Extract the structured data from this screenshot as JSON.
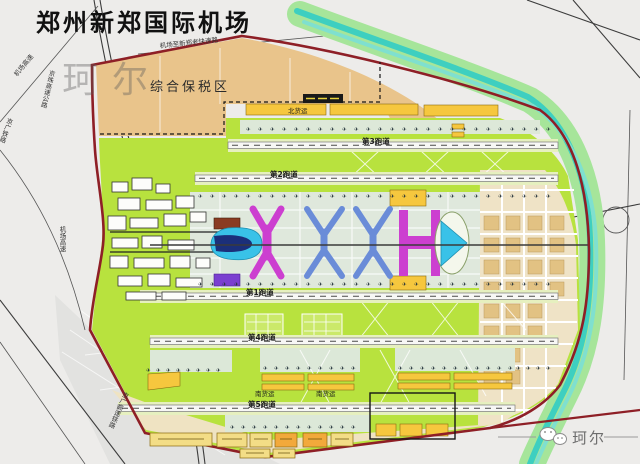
{
  "title": "郑州新郑国际机场",
  "watermark": {
    "topleft": "珂尔",
    "bottomright": "珂尔"
  },
  "zones": {
    "bonded": "综合保税区",
    "north_cargo": "北货运",
    "south_cargo_1": "南货运",
    "south_cargo_2": "南货运"
  },
  "runways": [
    {
      "label": "第3跑道"
    },
    {
      "label": "第2跑道"
    },
    {
      "label": "第1跑道"
    },
    {
      "label": "第4跑道"
    },
    {
      "label": "第5跑道"
    }
  ],
  "roads": {
    "top_expressway": "机场至新郑老快速路",
    "airport_expwy_nw": "机场高速",
    "airport_expwy_w": "机场高速",
    "jingzhu_expwy": "京珠高速公路",
    "railway": "京广铁路",
    "hsr": "京广高速铁路"
  },
  "colors": {
    "boundary_red": "#8e1f26",
    "airfield_green": "#b8e23e",
    "bonded_tan": "#e9c48b",
    "cargo_yellow": "#f6c73e",
    "river_green": "#a6e59a",
    "river_teal": "#3ecfc0",
    "terminal_magenta": "#cc3fd0",
    "terminal_blue": "#6a8cd8",
    "terminal_cyan": "#39c2e8",
    "city_block_tan": "#e2c283"
  },
  "decor": {
    "aircraft_glyph": "✈",
    "aircraft_rows": [
      {
        "x": 246,
        "y": 131,
        "n": 26,
        "g": 12
      },
      {
        "x": 198,
        "y": 198,
        "n": 30,
        "g": 12
      },
      {
        "x": 198,
        "y": 286,
        "n": 30,
        "g": 12
      },
      {
        "x": 146,
        "y": 372,
        "n": 8,
        "g": 10
      },
      {
        "x": 263,
        "y": 370,
        "n": 9,
        "g": 11
      },
      {
        "x": 398,
        "y": 370,
        "n": 11,
        "g": 11
      },
      {
        "x": 230,
        "y": 429,
        "n": 12,
        "g": 11
      },
      {
        "x": 516,
        "y": 370,
        "n": 4,
        "g": 10
      }
    ]
  }
}
